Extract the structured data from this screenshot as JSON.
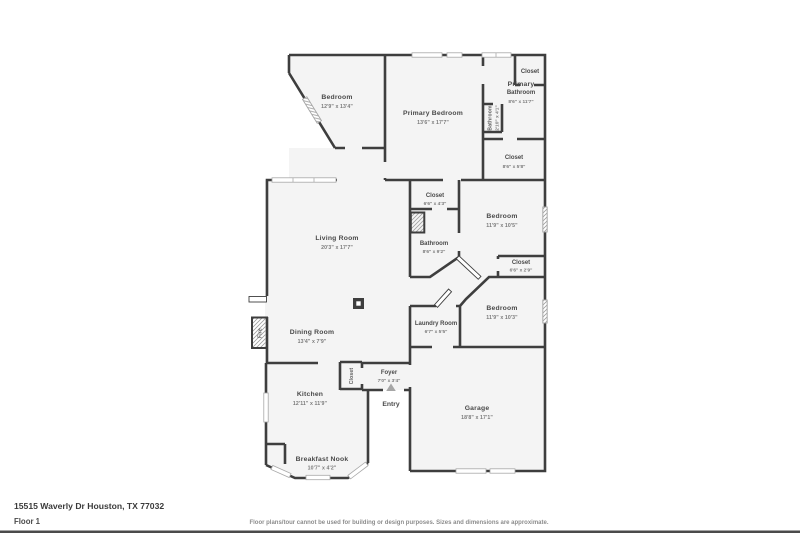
{
  "footer": {
    "address": "15515 Waverly Dr Houston, TX 77032",
    "floor_label": "Floor 1",
    "disclaimer": "Floor plans/tour cannot be used for building or design purposes. Sizes and dimensions are approximate."
  },
  "entry": {
    "label": "Entry"
  },
  "fireplace": {
    "label": "Fire"
  },
  "rooms": {
    "bedroom_tl": {
      "name": "Bedroom",
      "dims": "12'9\" x 13'4\""
    },
    "primary_bedroom": {
      "name": "Primary Bedroom",
      "dims": "13'6\" x 17'7\""
    },
    "closet_tr": {
      "name": "Closet"
    },
    "primary_bathroom": {
      "name1": "Primary",
      "name2": "Bathroom",
      "dims": "8'6\" x 11'7\""
    },
    "bathroom_small": {
      "name": "Bathroom",
      "dims": "2'10\" x 4'1\""
    },
    "closet_58": {
      "name": "Closet",
      "dims": "8'6\" x 5'8\""
    },
    "closet_43": {
      "name": "Closet",
      "dims": "6'6\" x 4'3\""
    },
    "bedroom_105": {
      "name": "Bedroom",
      "dims": "11'9\" x 10'5\""
    },
    "bathroom_92": {
      "name": "Bathroom",
      "dims": "8'6\" x 9'2\""
    },
    "closet_29": {
      "name": "Closet",
      "dims": "6'6\" x 2'9\""
    },
    "bedroom_103": {
      "name": "Bedroom",
      "dims": "11'9\" x 10'3\""
    },
    "living": {
      "name": "Living Room",
      "dims": "20'3\" x 17'7\""
    },
    "dining": {
      "name": "Dining Room",
      "dims": "13'4\" x 7'9\""
    },
    "laundry": {
      "name": "Laundry Room",
      "dims": "6'7\" x 5'5\""
    },
    "foyer": {
      "name": "Foyer",
      "dims": "7'0\" x 3'4\""
    },
    "closet_foyer": {
      "name": "Closet"
    },
    "kitchen": {
      "name": "Kitchen",
      "dims": "12'11\" x 11'9\""
    },
    "breakfast": {
      "name": "Breakfast Nook",
      "dims": "10'7\" x 4'2\""
    },
    "garage": {
      "name": "Garage",
      "dims": "18'8\" x 17'1\""
    }
  }
}
